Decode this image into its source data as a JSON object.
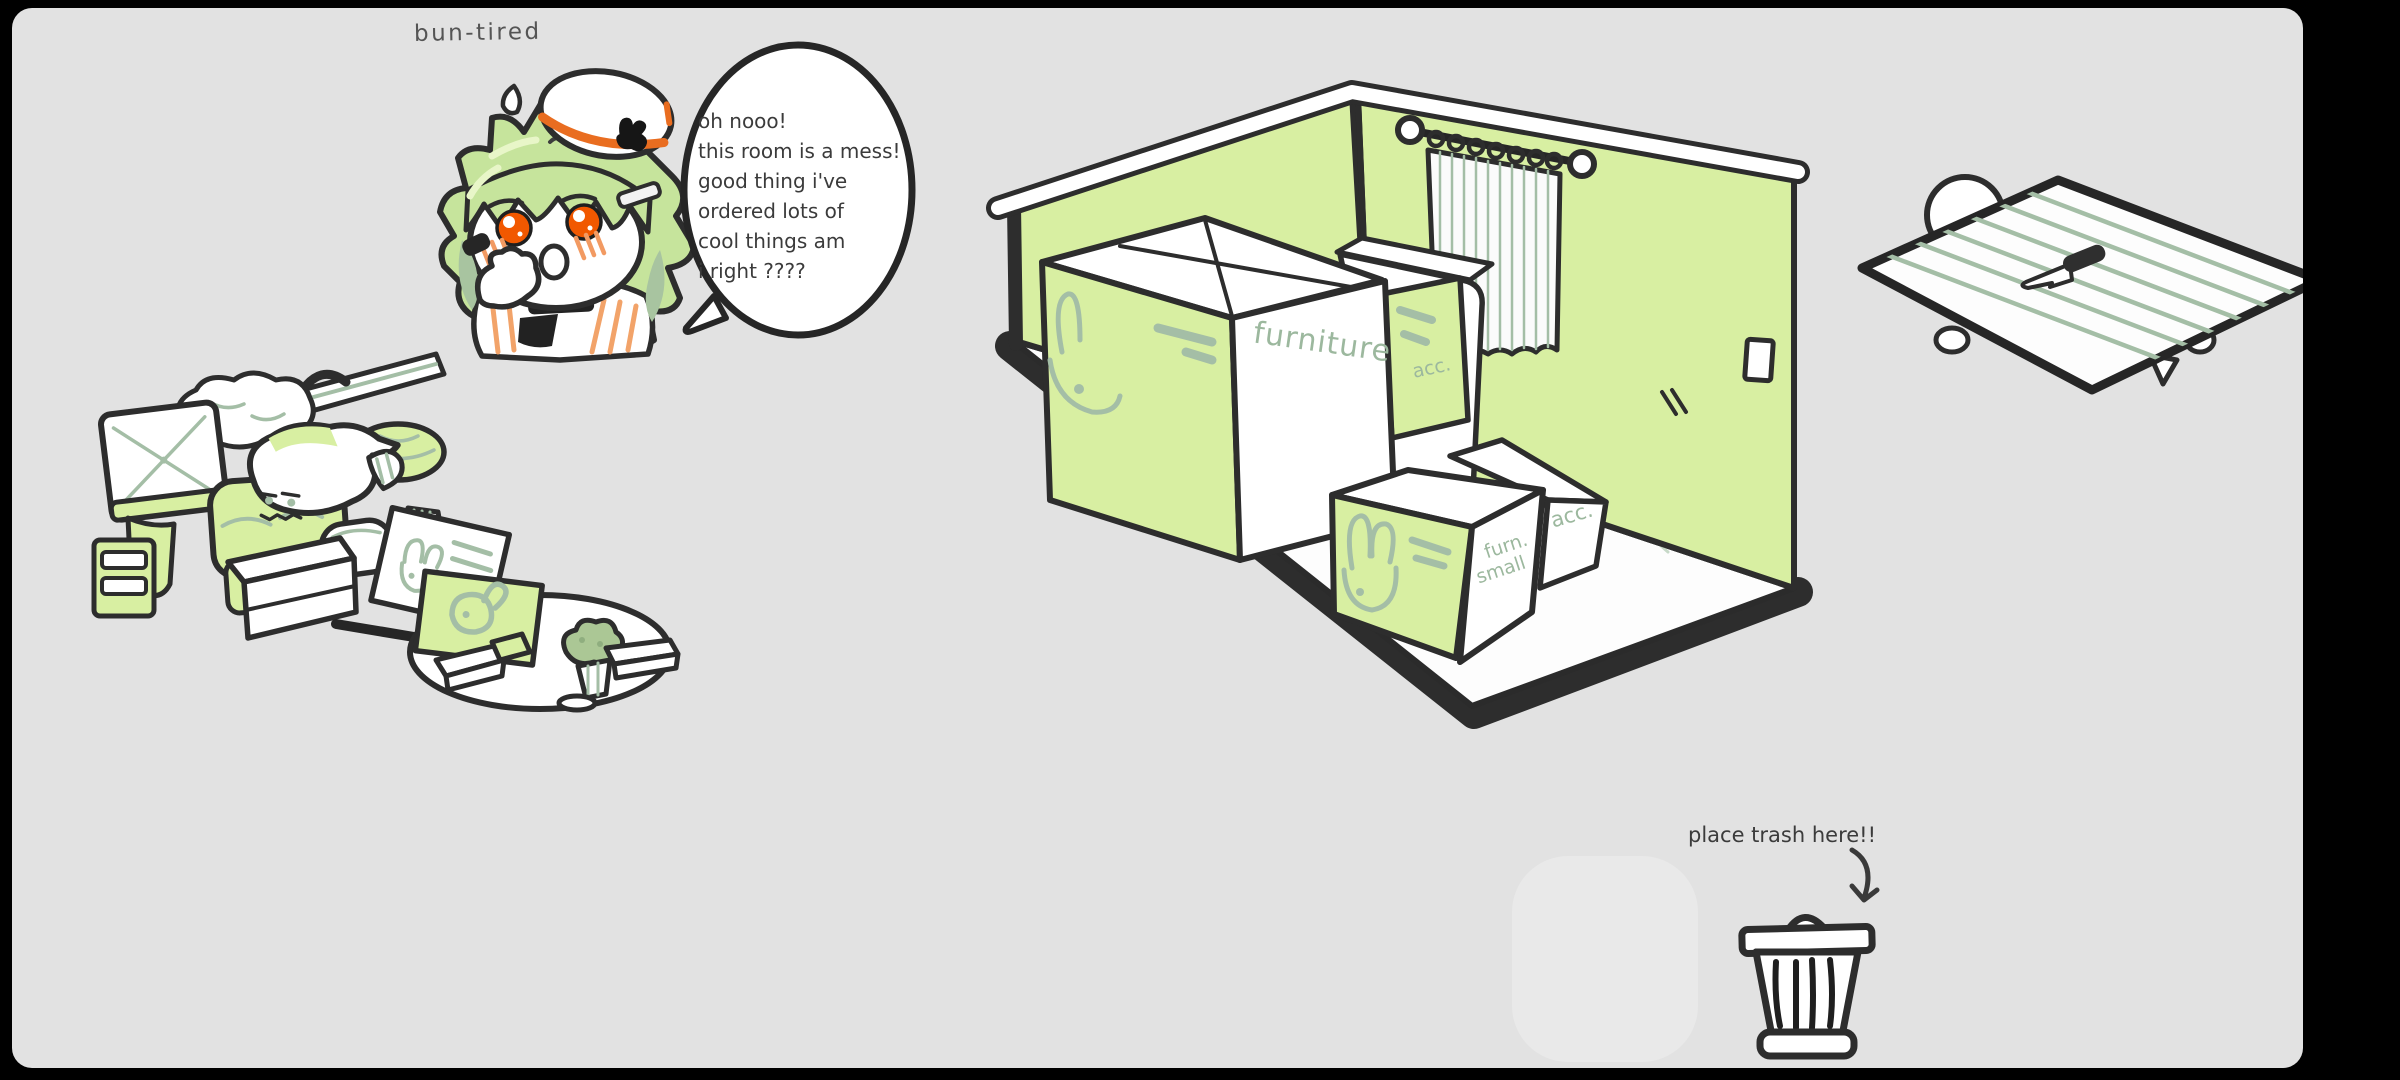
{
  "scene": {
    "artist_signature": "bun-tired",
    "background_color": "#e2e2e2",
    "frame_color": "#000000"
  },
  "palette": {
    "outline": "#2d2d2d",
    "green": "#d8efa2",
    "sage": "#a4bea6",
    "sage_text": "#9cb89e",
    "hair_green": "#c6e49c",
    "hair_shade": "#a8c4a0",
    "eye_orange": "#f15800",
    "accent_orange": "#e96d20",
    "blush_orange": "#f29a62",
    "ink": "#3b3b3b",
    "white": "#ffffff"
  },
  "character": {
    "id": "chibi-bunny-beret",
    "speech": {
      "lines": [
        "oh nooo!",
        "this room is a mess!",
        "good thing i've",
        "ordered lots of",
        "cool things am",
        "i right ????"
      ]
    }
  },
  "room": {
    "box_labels": {
      "big": "furniture",
      "side": "acc.",
      "small_line1": "furn.",
      "small_line2": "small",
      "mid": "acc."
    }
  },
  "trash_zone": {
    "instruction": "place trash here!!"
  }
}
